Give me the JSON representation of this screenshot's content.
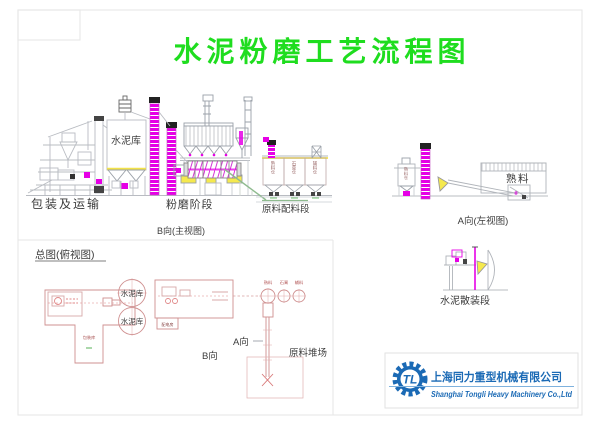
{
  "title": "水泥粉磨工艺流程图",
  "colors": {
    "title_green": "#1fdd1f",
    "magenta": "#e600e6",
    "yellow": "#f5e94e",
    "logo_blue": "#1b6ab5",
    "line_gray": "#b9bcc2",
    "plan_red": "#cf9090",
    "conveyor_green": "#8fbb8f"
  },
  "main_view": {
    "caption": "B向(主视图)",
    "sections": {
      "packaging": "包装及运输",
      "cement_silo": "水泥库",
      "grinding": "粉磨阶段",
      "batching": "原料配料段"
    },
    "batching_silos": [
      "熟料仓",
      "石膏仓",
      "辅料仓"
    ]
  },
  "left_view": {
    "caption": "A向(左视图)",
    "clinker_shed": "熟料",
    "clinker_silo": "熟料仓"
  },
  "bulk_section": {
    "caption": "水泥散装段"
  },
  "plan_view": {
    "caption": "总图(俯视图)",
    "cement_silo_1": "水泥库",
    "cement_silo_2": "水泥库",
    "packaging_room": "包装库",
    "power_room": "配电房",
    "b_dir": "B向",
    "a_dir": "A向",
    "stockyard": "原料堆场",
    "feed_bins": [
      "熟料",
      "石膏",
      "辅料"
    ]
  },
  "logo": {
    "monogram": "TL",
    "company_cn": "上海同力重型机械有限公司",
    "company_en": "Shanghai Tongli Heavy Machinery Co.,Ltd"
  }
}
